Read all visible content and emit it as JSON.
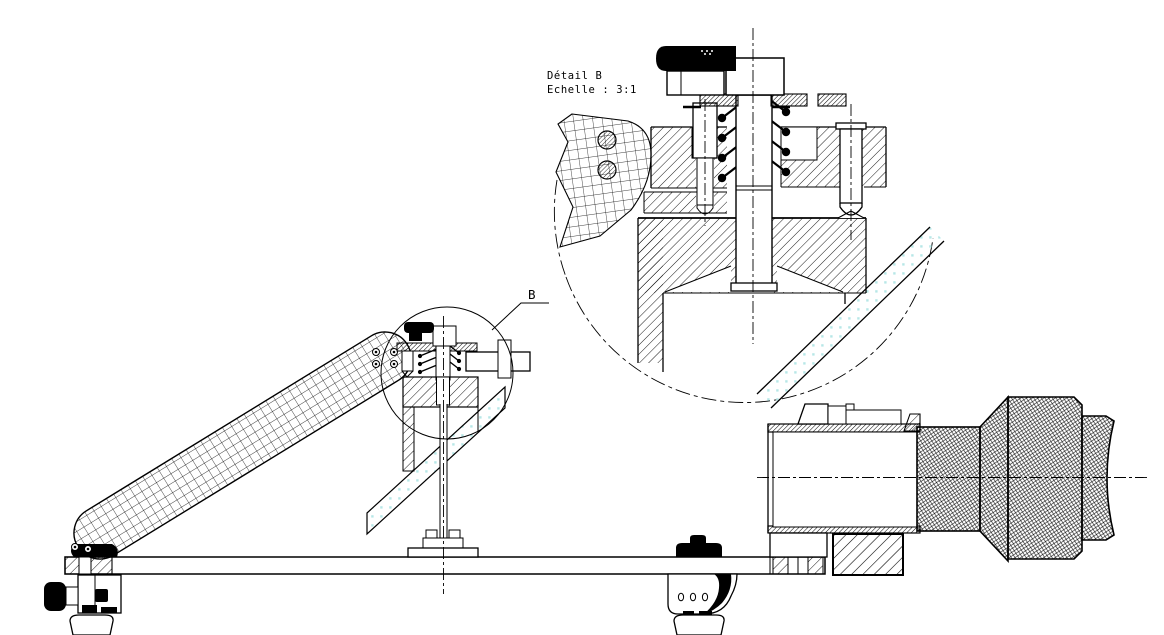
{
  "page": {
    "background": "#ffffff",
    "ink_color": "#000000",
    "mirror_dot_color": "#b7e7e7"
  },
  "annotations": {
    "detail_title": "Détail B",
    "detail_scale": "Echelle :  3:1",
    "marker_label": "B"
  }
}
